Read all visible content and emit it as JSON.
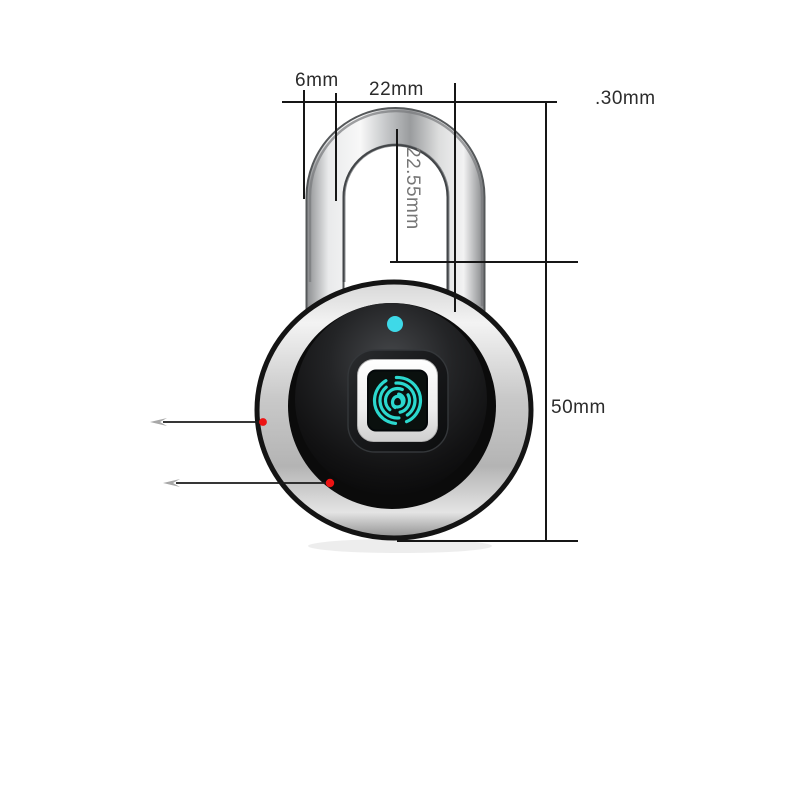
{
  "scene": {
    "kind": "product-dimension-diagram",
    "background": "#ffffff"
  },
  "dims": {
    "shackle_wire_diameter": "6mm",
    "shackle_inner_width": "22mm",
    "offset_note": ".30mm",
    "shackle_inner_height": "22.55mm",
    "body_height": "50mm"
  },
  "colors": {
    "led_indicator": "#3ed9e8",
    "fingerprint_glyph": "#2bd8ce",
    "marker_dot": "#ec1313",
    "dimension_line": "#1a1a1a",
    "annotation_text": "#2b2b2b",
    "vertical_text": "#767676"
  },
  "icons": {
    "fingerprint": "fingerprint-icon",
    "led": "led-indicator-dot",
    "markers": "red-marker-dot"
  }
}
